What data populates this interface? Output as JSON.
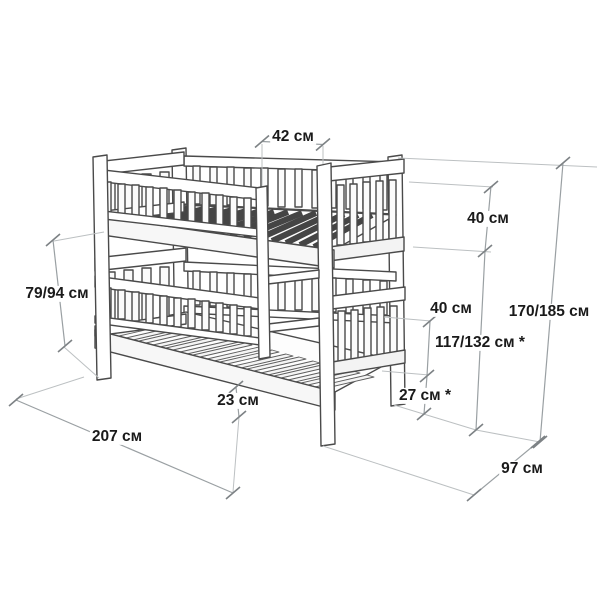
{
  "colors": {
    "background": "#ffffff",
    "drawing_line": "#4a4a4a",
    "dimension_line": "#9aa0a3",
    "label_text": "#1a1a1a"
  },
  "unit_suffix": "см",
  "dimensions": {
    "ladder_opening_width": {
      "label": "42 см"
    },
    "upper_guard_height": {
      "label": "40 см"
    },
    "under_upper_bunk_clearance": {
      "label": "79/94 см"
    },
    "lower_guard_height": {
      "label": "40 см"
    },
    "total_height": {
      "label": "170/185 см"
    },
    "upper_frame_underside_height": {
      "label": "117/132 см *"
    },
    "lower_frame_floor_clearance": {
      "label": "23 см"
    },
    "lower_frame_height": {
      "label": "27 см *"
    },
    "bed_length": {
      "label": "207 см"
    },
    "bed_width": {
      "label": "97 см"
    }
  }
}
